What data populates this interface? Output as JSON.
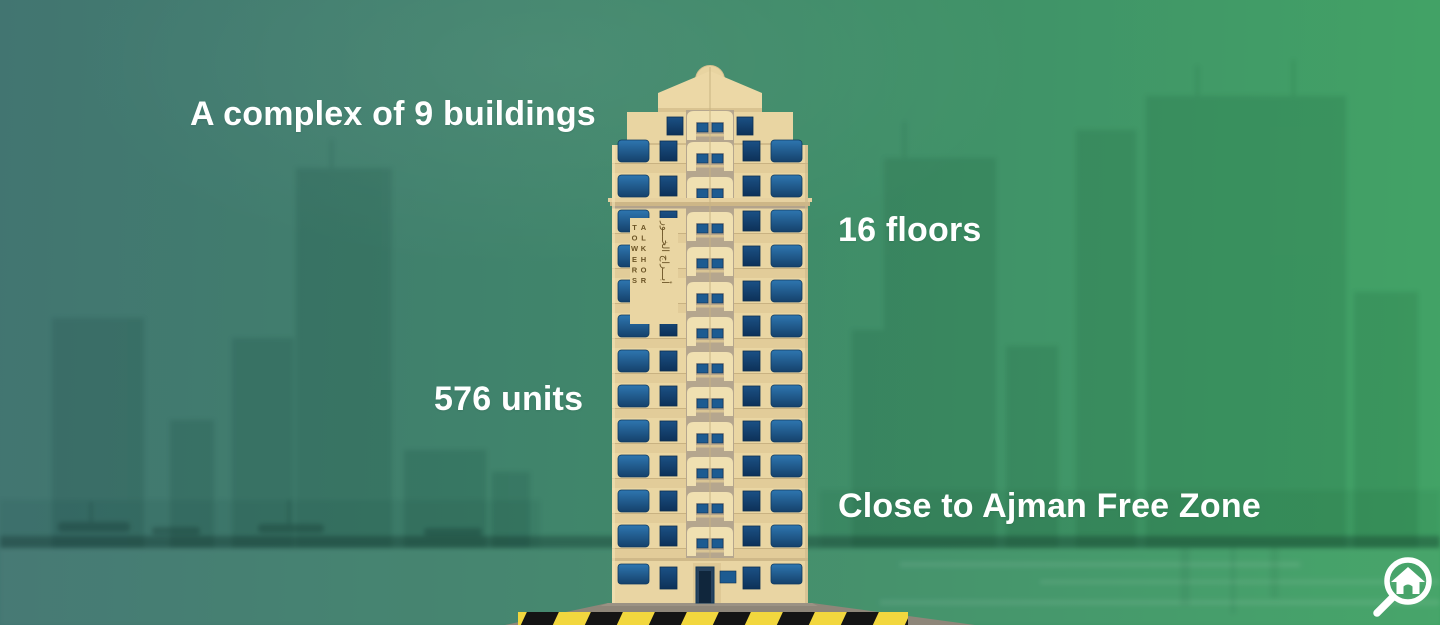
{
  "labels": {
    "buildings": "A complex of 9 buildings",
    "floors": "16 floors",
    "units": "576 units",
    "location": "Close to Ajman Free Zone"
  },
  "tower_sign": {
    "name_en": "ALKHOR TOWERS",
    "name_ar": "أبـــراج الخـــور"
  },
  "icons": {
    "logo": "home-search-magnifier-icon"
  },
  "colors": {
    "bg_teal_left": "#427571",
    "bg_green_right": "#42A366",
    "label_text": "#FFFFFF",
    "tower_cream": "#EAD6A3",
    "window_blue": "#1D5B91",
    "balcony_gray": "#B5A68E",
    "hazard_yellow": "#F2D73E",
    "hazard_black": "#141414",
    "platform_gray": "#8E8679"
  }
}
